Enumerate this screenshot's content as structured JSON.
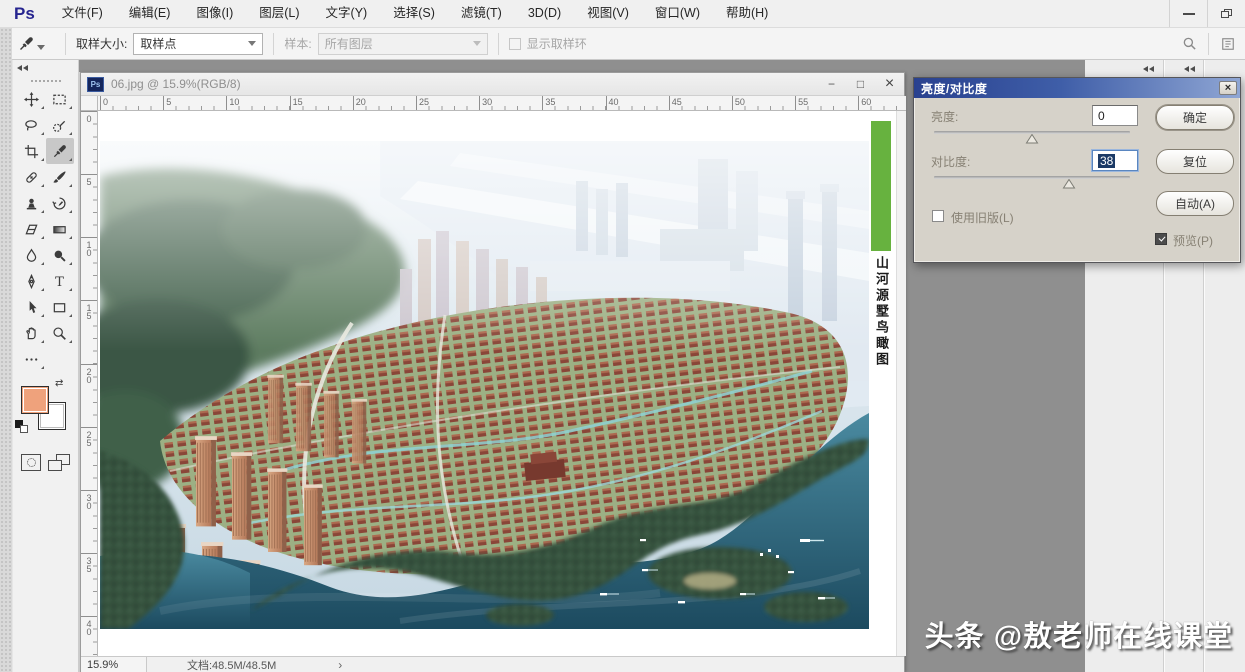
{
  "app": {
    "logo": "Ps",
    "menu_items": [
      "文件(F)",
      "编辑(E)",
      "图像(I)",
      "图层(L)",
      "文字(Y)",
      "选择(S)",
      "滤镜(T)",
      "3D(D)",
      "视图(V)",
      "窗口(W)",
      "帮助(H)"
    ]
  },
  "options_bar": {
    "tool_icon": "eyedropper-icon",
    "sample_size_label": "取样大小:",
    "sample_size_value": "取样点",
    "sample_label": "样本:",
    "sample_value": "所有图层",
    "show_ring_label": "显示取样环"
  },
  "toolbar": {
    "selected_tool": "eyedropper",
    "tools": [
      "move",
      "rectangular-marquee",
      "lasso",
      "quick-selection",
      "crop",
      "eyedropper",
      "spot-healing",
      "brush",
      "clone-stamp",
      "history-brush",
      "eraser",
      "gradient",
      "blur",
      "dodge",
      "pen",
      "type",
      "path-selection",
      "shape",
      "hand",
      "zoom",
      "more-options"
    ],
    "foreground_color": "#efa27c",
    "background_color": "#ffffff"
  },
  "document": {
    "title": "06.jpg @ 15.9%(RGB/8)",
    "file_icon": "Ps",
    "ruler_h": [
      "0",
      "5",
      "10",
      "15",
      "20",
      "25",
      "30",
      "35",
      "40",
      "45",
      "50",
      "55",
      "60"
    ],
    "ruler_v": [
      "0",
      "5",
      "10",
      "15",
      "20",
      "25",
      "30",
      "35",
      "40"
    ],
    "image_side_label": "山河源墅鸟瞰图",
    "controls": {
      "minimize": "−",
      "maximize": "□",
      "close": "×"
    }
  },
  "dialog": {
    "title": "亮度/对比度",
    "close_glyph": "×",
    "brightness_label": "亮度:",
    "brightness_value": "0",
    "contrast_label": "对比度:",
    "contrast_value": "38",
    "ok_label": "确定",
    "reset_label": "复位",
    "auto_label": "自动(A)",
    "legacy_label": "使用旧版(L)",
    "legacy_checked": false,
    "preview_label": "预览(P)",
    "preview_checked": true
  },
  "status_bar": {
    "zoom_value": "15.9%",
    "doc_info": "文档:48.5M/48.5M",
    "expand_glyph": "›"
  },
  "watermark": {
    "text": "头条 @敖老师在线课堂"
  },
  "colors": {
    "poster_strip_green": "#67b23f",
    "selection_navy": "#1c3a66",
    "foreground_swatch": "#efa27c"
  }
}
